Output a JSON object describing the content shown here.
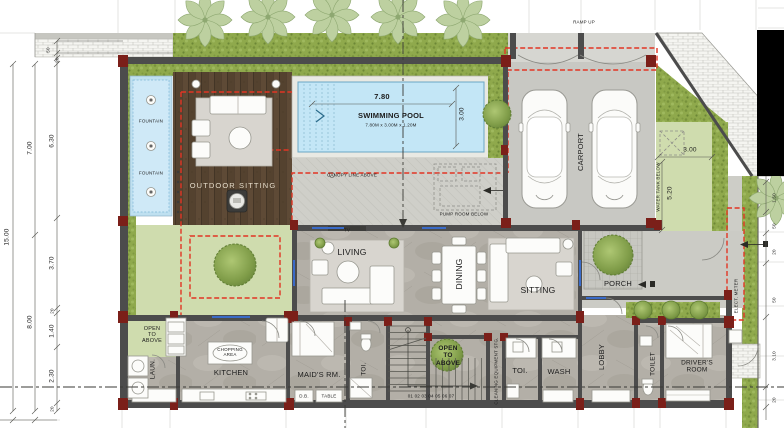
{
  "labels": {
    "fountain": "FOUNTAIN",
    "outdoor_sitting": "OUTDOOR SITTING",
    "swimming_pool": "SWIMMING POOL",
    "pool_spec": "7.80M x 3.00M x 1.20M",
    "canopy_line": "CANOPY LINE ABOVE",
    "pump_room": "PUMP ROOM BELOW",
    "ramp_up": "RAMP UP",
    "carport": "CARPORT",
    "water_tank": "WATER TANK BELOW",
    "tv": "TV",
    "living": "LIVING",
    "dining": "DINING",
    "sitting": "SITTING",
    "porch": "PORCH",
    "open_to_above": "OPEN\nTO\nABOVE",
    "laundry": "LAUN.",
    "kitchen": "KITCHEN",
    "chopping_area": "CHOPPING\nAREA",
    "maids_room": "MAID'S RM.",
    "toi": "TOI.",
    "wash": "WASH",
    "lobby": "LOBBY",
    "toilet": "TOILET",
    "drivers_room": "DRIVER'S\nROOM",
    "cleaning_stg": "CLEANING EQUIPMENT STG.",
    "elect_meter": "ELECT. METER",
    "db": "D.B.",
    "table": "TABLE",
    "stair_numbers": "01 02 03 04 05 06 07"
  },
  "dims": {
    "total_left": "15.00",
    "left_upper": "7.00",
    "left_lower": "8.00",
    "inner": [
      "50",
      "20",
      "6.30",
      "3.70",
      "20",
      "1.40",
      "2.30",
      "20"
    ],
    "right": [
      "1.50",
      "50",
      "20",
      "50",
      "3.10",
      "20"
    ],
    "pool_length": "7.80",
    "pool_width": "3.00",
    "lawn_width": "3.00",
    "lawn_depth": "5.20"
  },
  "colors": {
    "wall": "#4c4c4c",
    "column_red": "#7b1f19",
    "dashed_red": "#e23524",
    "pool_blue": "#c3e6f6",
    "lawn_green": "#cfdcae",
    "hedge_green": "#8fa94c",
    "deck_wood": "#54422f",
    "door_blue": "#3a6bc8"
  }
}
